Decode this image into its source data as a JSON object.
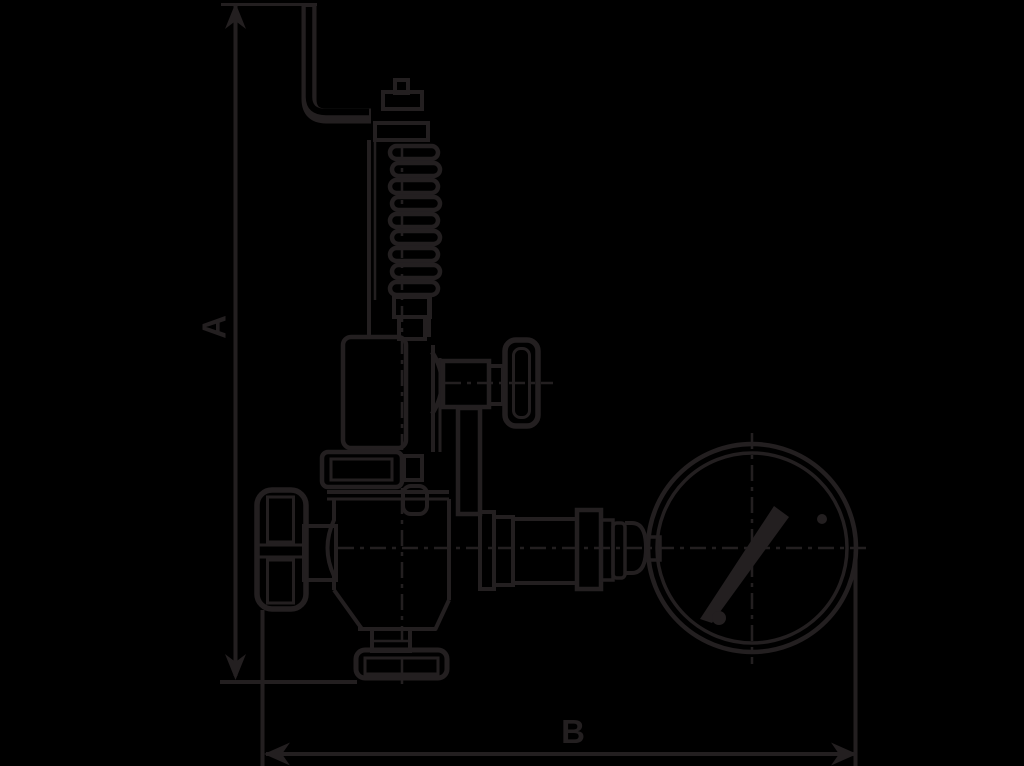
{
  "canvas": {
    "background_color": "#000000",
    "line_color": "#231f20"
  },
  "diagram": {
    "type": "technical-line-drawing",
    "subject": "Safety relief valve with test lever, spring bonnet, two handwheels and pressure gauge",
    "dimension_a_label": "A",
    "dimension_b_label": "B"
  }
}
